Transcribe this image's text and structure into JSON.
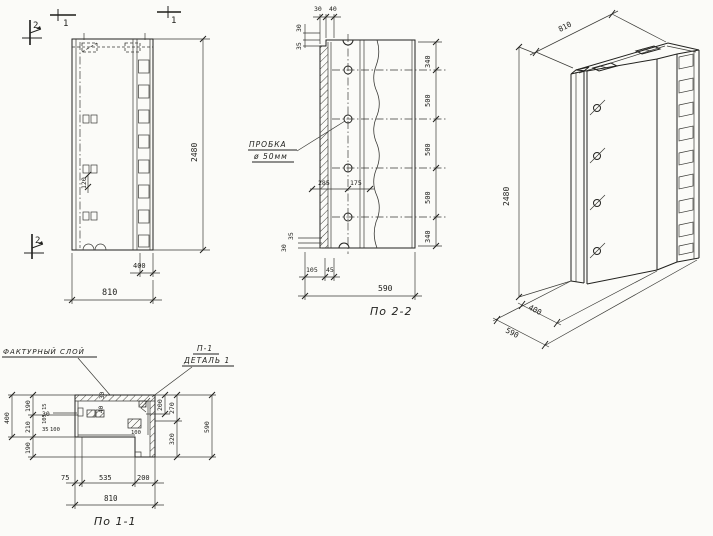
{
  "drawing": {
    "elevation": {
      "dim_height": "2480",
      "dim_width": "810",
      "dim_edge": "400",
      "dim_bracket": "120",
      "mark_1a": "1",
      "mark_1b": "1",
      "mark_2a": "2",
      "mark_2b": "2"
    },
    "s22": {
      "title": "По 2-2",
      "plug_line1": "ПРОБКА",
      "plug_line2": "ø 50мм",
      "top_d1": "30",
      "top_d2": "40",
      "topleft_d1": "30",
      "topleft_d2": "35",
      "right_d1": "340",
      "right_d2": "500",
      "right_d3": "500",
      "right_d4": "500",
      "right_d5": "340",
      "mid_d1": "285",
      "mid_d2": "175",
      "botleft_d1": "35",
      "botleft_d2": "30",
      "bottom_d1": "105",
      "bottom_d2": "45",
      "bottom_total": "590"
    },
    "iso": {
      "dim_width": "810",
      "dim_height": "2480",
      "dim_body": "400",
      "dim_depth": "590"
    },
    "s11": {
      "title": "По 1-1",
      "facing_label": "ФАКТУРНЫЙ СЛОЙ",
      "detail_ref": "П-1",
      "detail_name": "ДЕТАЛЬ 1",
      "left_d1": "190",
      "left_d2": "210",
      "left_d3": "190",
      "left_total": "400",
      "right_d1": "200",
      "right_d2": "270",
      "right_d3": "320",
      "right_total": "590",
      "bottom_d1": "75",
      "bottom_d2": "535",
      "bottom_d3": "200",
      "bottom_total": "810",
      "sm_30top": "30",
      "sm_40": "40",
      "sm_30": "30",
      "sm_15": "15",
      "sm_105": "105",
      "sm_35": "35",
      "sm_100": "100",
      "sm_100b": "100"
    }
  }
}
